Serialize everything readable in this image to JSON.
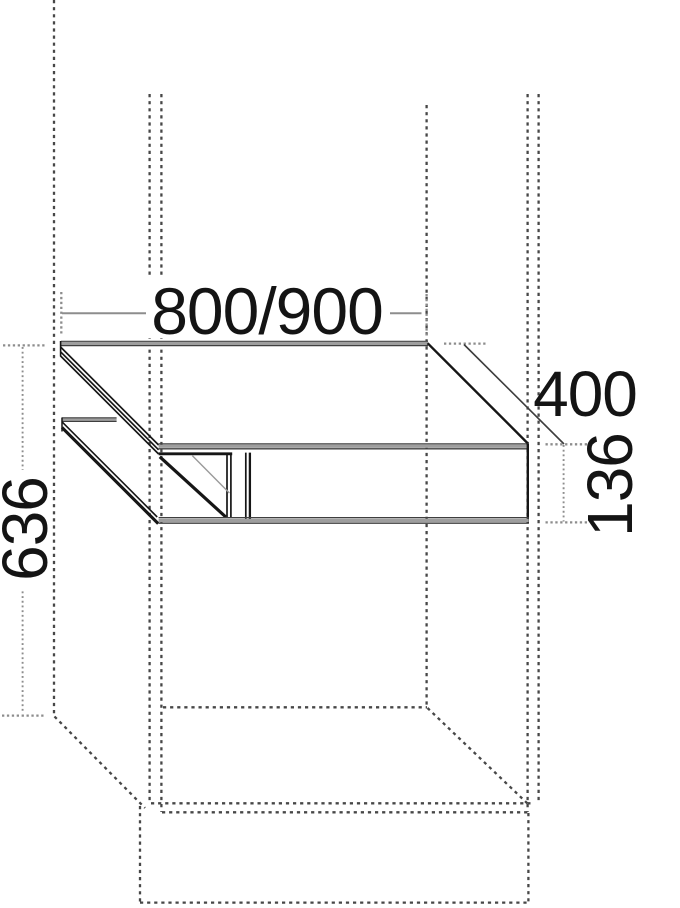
{
  "drawing": {
    "kind": "furniture-technical-drawing",
    "dimensions": {
      "width_label": "800/900",
      "depth_label": "400",
      "front_height_label": "136",
      "niche_height_label": "636"
    }
  },
  "colors": {
    "background": "#ffffff",
    "ink": "#161616",
    "band_grey": "#9e9e9e",
    "band_edge": "#3f3f3f",
    "dashed_outline": "#474747",
    "dimension_grey": "#8d8d8d",
    "label_text": "#141414"
  }
}
